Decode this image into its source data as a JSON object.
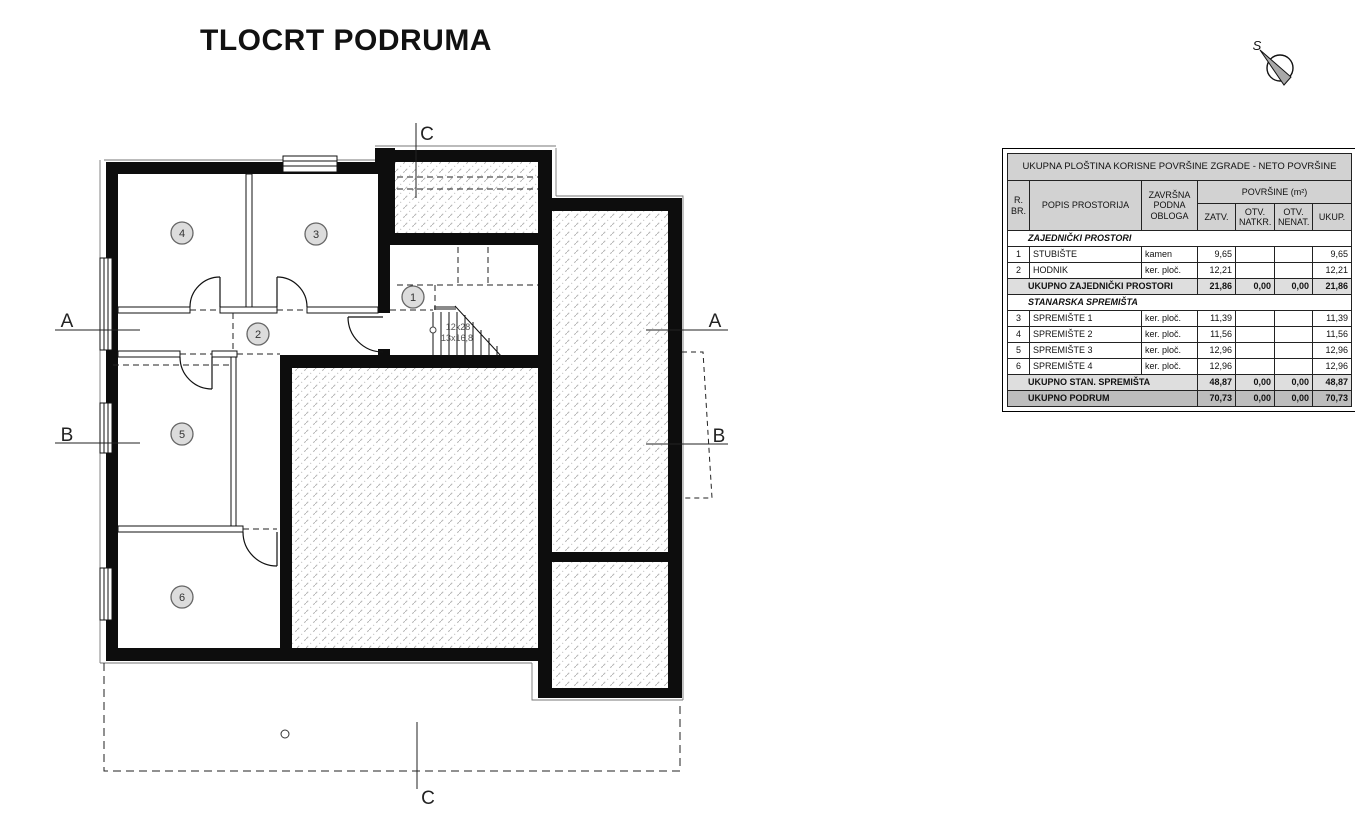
{
  "title": "TLOCRT PODRUMA",
  "north": {
    "label": "S"
  },
  "plan": {
    "rooms": [
      {
        "number": "1"
      },
      {
        "number": "2"
      },
      {
        "number": "3"
      },
      {
        "number": "4"
      },
      {
        "number": "5"
      },
      {
        "number": "6"
      }
    ],
    "sections": {
      "a_left": "A",
      "b_left": "B",
      "a_right": "A",
      "b_right": "B",
      "c_top": "C",
      "c_bottom": "C"
    },
    "stair_note": {
      "line1": "12x28",
      "line2": "13x16,8"
    }
  },
  "table": {
    "title": "UKUPNA PLOŠTINA KORISNE POVRŠINE ZGRADE - NETO POVRŠINE",
    "headers": {
      "rbr": "R. BR.",
      "popis": "POPIS PROSTORIJA",
      "obloga": "ZAVRŠNA PODNA OBLOGA",
      "povrsine": "POVRŠINE (m²)",
      "zatv": "ZATV.",
      "natkr": "OTV. NATKR.",
      "nenat": "OTV. NENAT.",
      "ukup": "UKUP."
    },
    "rows": [
      {
        "type": "section",
        "label": "ZAJEDNIČKI PROSTORI"
      },
      {
        "type": "data",
        "num": "1",
        "name": "STUBIŠTE",
        "finish": "kamen",
        "zatv": "9,65",
        "natkr": "",
        "nenat": "",
        "ukup": "9,65"
      },
      {
        "type": "data",
        "num": "2",
        "name": "HODNIK",
        "finish": "ker. ploč.",
        "zatv": "12,21",
        "natkr": "",
        "nenat": "",
        "ukup": "12,21"
      },
      {
        "type": "total",
        "label": "UKUPNO ZAJEDNIČKI PROSTORI",
        "zatv": "21,86",
        "natkr": "0,00",
        "nenat": "0,00",
        "ukup": "21,86"
      },
      {
        "type": "section",
        "label": "STANARSKA SPREMIŠTA"
      },
      {
        "type": "data",
        "num": "3",
        "name": "SPREMIŠTE 1",
        "finish": "ker. ploč.",
        "zatv": "11,39",
        "natkr": "",
        "nenat": "",
        "ukup": "11,39"
      },
      {
        "type": "data",
        "num": "4",
        "name": "SPREMIŠTE 2",
        "finish": "ker. ploč.",
        "zatv": "11,56",
        "natkr": "",
        "nenat": "",
        "ukup": "11,56"
      },
      {
        "type": "data",
        "num": "5",
        "name": "SPREMIŠTE 3",
        "finish": "ker. ploč.",
        "zatv": "12,96",
        "natkr": "",
        "nenat": "",
        "ukup": "12,96"
      },
      {
        "type": "data",
        "num": "6",
        "name": "SPREMIŠTE 4",
        "finish": "ker. ploč.",
        "zatv": "12,96",
        "natkr": "",
        "nenat": "",
        "ukup": "12,96"
      },
      {
        "type": "total",
        "label": "UKUPNO STAN. SPREMIŠTA",
        "zatv": "48,87",
        "natkr": "0,00",
        "nenat": "0,00",
        "ukup": "48,87"
      },
      {
        "type": "total",
        "label": "UKUPNO PODRUM",
        "zatv": "70,73",
        "natkr": "0,00",
        "nenat": "0,00",
        "ukup": "70,73"
      }
    ]
  },
  "colors": {
    "wall": "#0d0d0d",
    "hatch": "#b5b5b5",
    "table_header_bg": "#d2d2d2",
    "total_light_bg": "#dedede",
    "total_dark_bg": "#bdbdbd"
  }
}
